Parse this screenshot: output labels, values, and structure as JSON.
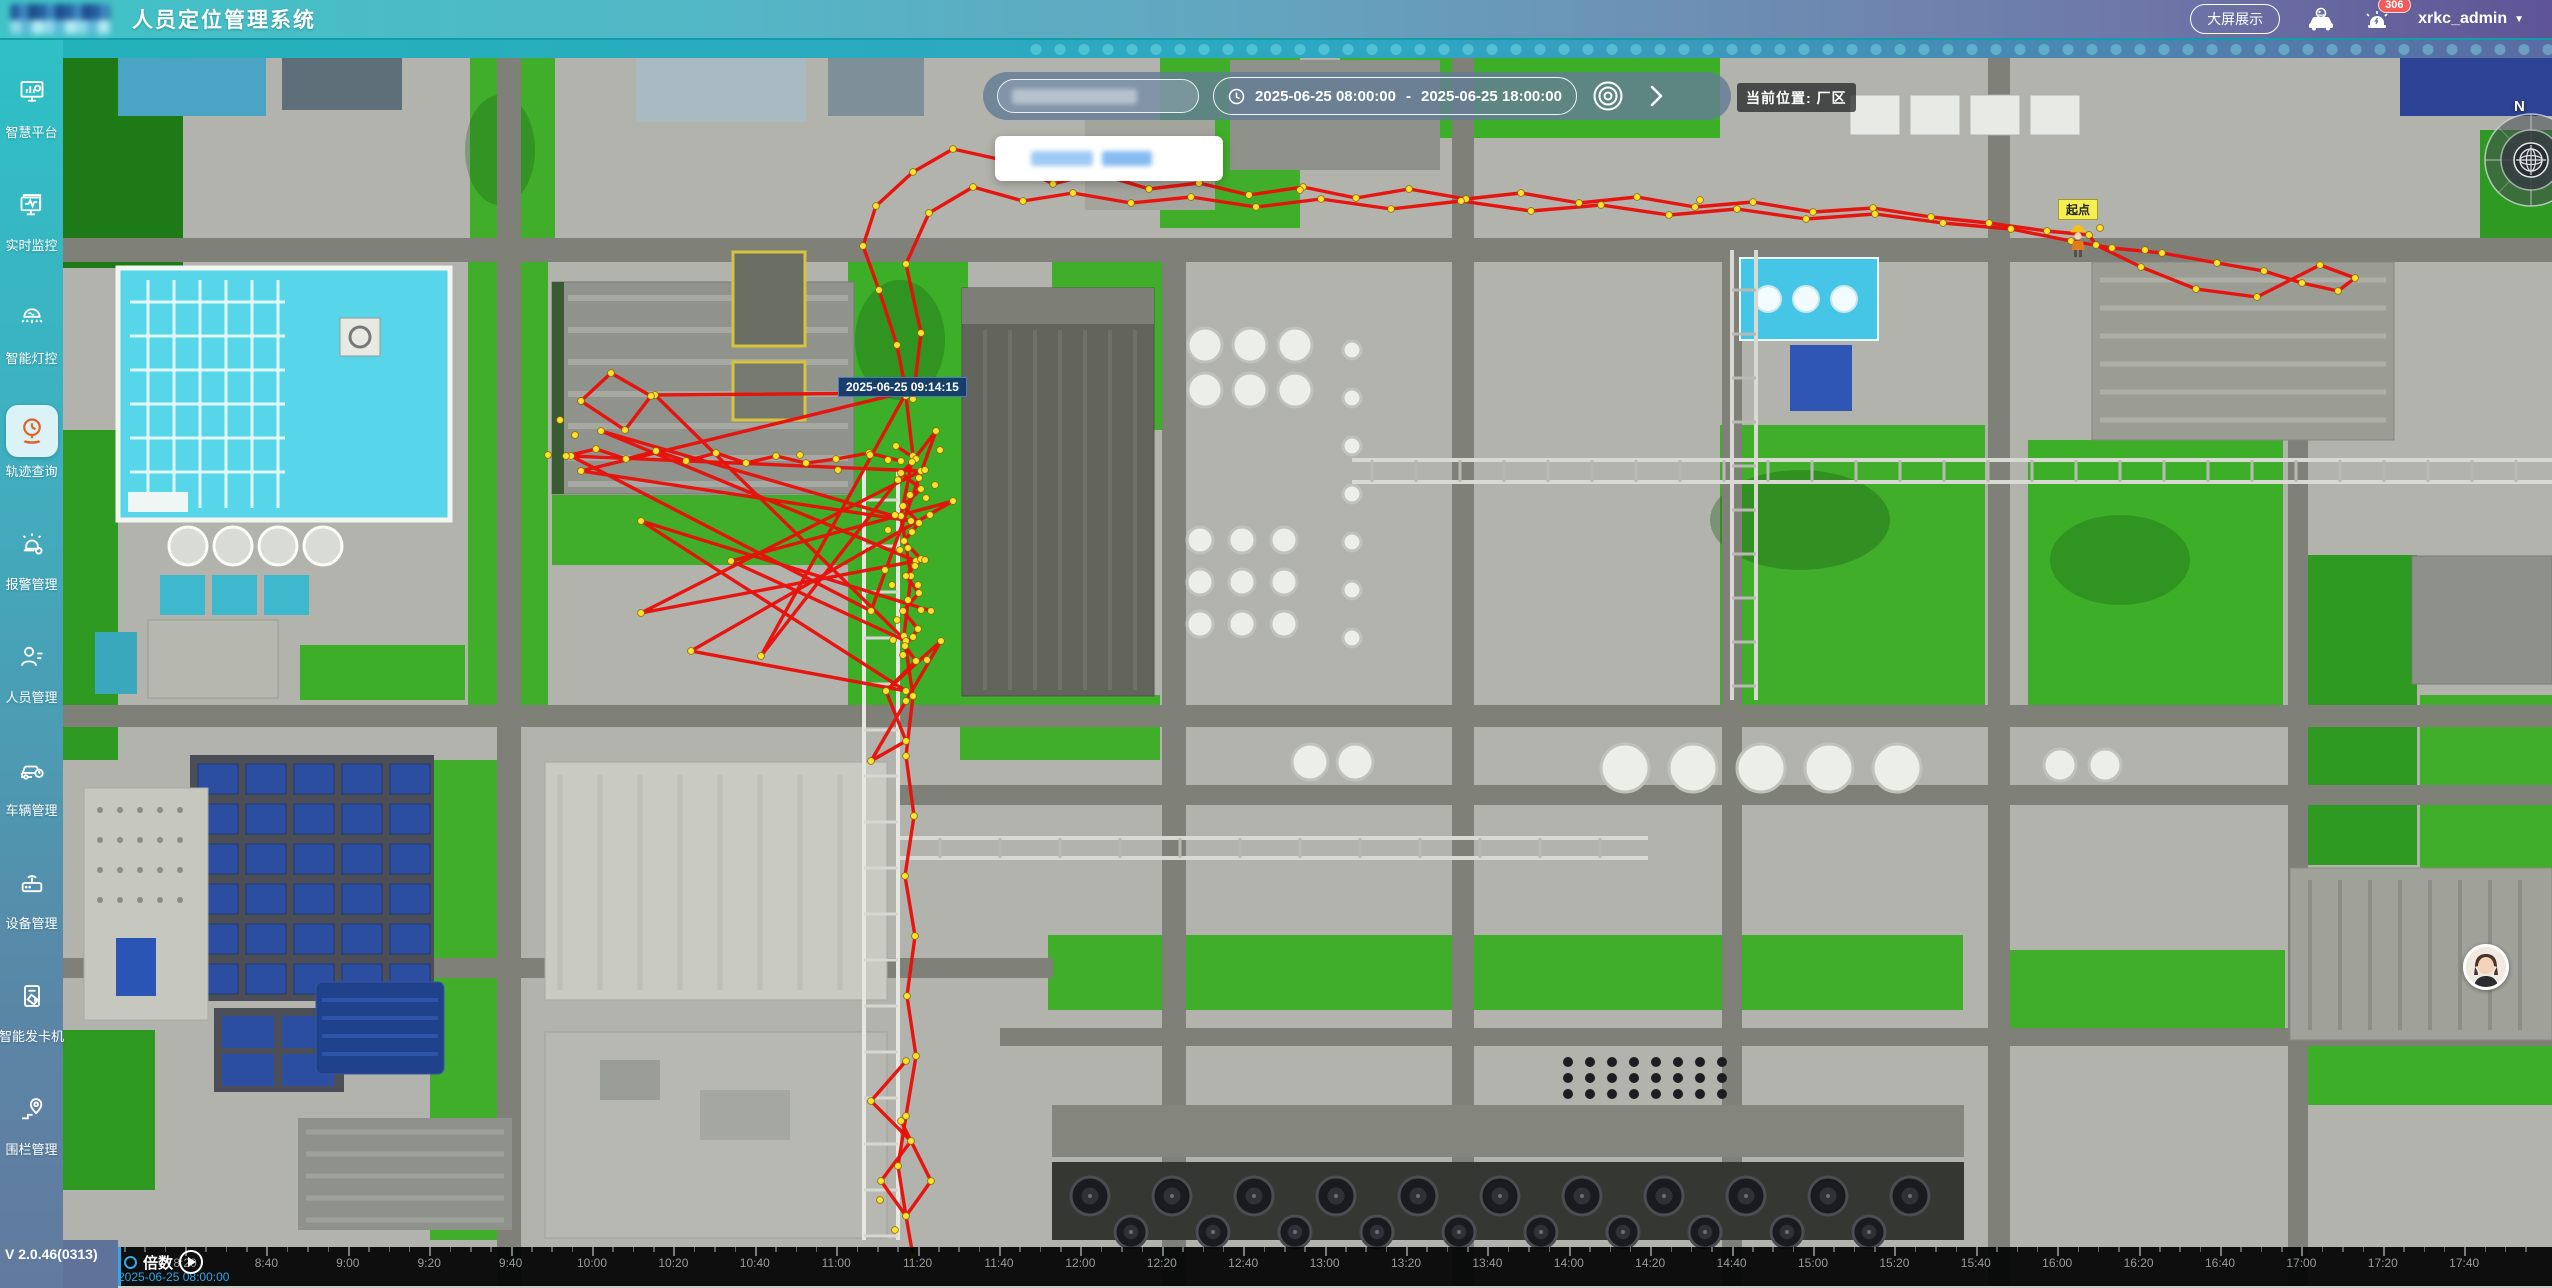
{
  "header": {
    "title": "人员定位管理系统",
    "big_screen_button": "大屏展示",
    "notification_badge": "306",
    "username": "xrkc_admin"
  },
  "sidebar": {
    "items": [
      {
        "label": "智慧平台",
        "icon": "dashboard-monitor-icon",
        "active": false
      },
      {
        "label": "实时监控",
        "icon": "realtime-monitor-icon",
        "active": false
      },
      {
        "label": "智能灯控",
        "icon": "smart-light-icon",
        "active": false
      },
      {
        "label": "轨迹查询",
        "icon": "track-query-icon",
        "active": true
      },
      {
        "label": "报警管理",
        "icon": "alarm-icon",
        "active": false
      },
      {
        "label": "人员管理",
        "icon": "person-icon",
        "active": false
      },
      {
        "label": "车辆管理",
        "icon": "vehicle-icon",
        "active": false
      },
      {
        "label": "设备管理",
        "icon": "device-icon",
        "active": false
      },
      {
        "label": "智能发卡机",
        "icon": "card-dispenser-icon",
        "active": false
      },
      {
        "label": "围栏管理",
        "icon": "fence-icon",
        "active": false
      }
    ],
    "version": "V 2.0.46(0313)"
  },
  "toolbar": {
    "date_start": "2025-06-25 08:00:00",
    "date_separator": "-",
    "date_end": "2025-06-25 18:00:00",
    "location_label": "当前位置: 厂区"
  },
  "map": {
    "tooltip_time": "2025-06-25 09:14:15",
    "start_point_label": "起点",
    "compass_north": "N",
    "track_color": "#e90f08",
    "dot_color": "#ffe22e"
  },
  "timeline": {
    "speed_label": "倍数",
    "current_time": "2025-06-25 08:00:00",
    "tick_labels": [
      "8:20",
      "8:40",
      "9:00",
      "9:20",
      "9:40",
      "10:00",
      "10:20",
      "10:40",
      "11:00",
      "11:20",
      "11:40",
      "12:00",
      "12:20",
      "12:40",
      "13:00",
      "13:20",
      "13:40",
      "14:00",
      "14:20",
      "14:40",
      "15:00",
      "15:20",
      "15:40",
      "16:00",
      "16:20",
      "16:40",
      "17:00",
      "17:20",
      "17:40"
    ]
  },
  "trajectory": {
    "paths": [
      [
        906,
        392,
        897,
        345,
        879,
        290,
        863,
        246,
        876,
        206,
        913,
        172,
        953,
        149,
        1007,
        161,
        1053,
        184,
        1096,
        173,
        1149,
        189,
        1199,
        183,
        1249,
        195,
        1303,
        187,
        1356,
        198,
        1409,
        189,
        1466,
        199,
        1521,
        193,
        1579,
        203,
        1637,
        197,
        1695,
        207,
        1753,
        202,
        1813,
        212,
        1873,
        208,
        1931,
        217,
        1989,
        223,
        2047,
        231,
        2089,
        235
      ],
      [
        913,
        399,
        921,
        333,
        906,
        264,
        929,
        213,
        973,
        187,
        1023,
        201,
        1073,
        193,
        1131,
        203,
        1191,
        197,
        1256,
        207,
        1321,
        199,
        1391,
        209,
        1461,
        201,
        1531,
        211,
        1601,
        205,
        1669,
        215,
        1737,
        209,
        1806,
        219,
        1875,
        214,
        1943,
        223,
        2011,
        229,
        2071,
        241,
        2112,
        248,
        2162,
        253,
        2217,
        263,
        2264,
        271,
        2302,
        283,
        2338,
        291,
        2355,
        278,
        2320,
        265,
        2257,
        297,
        2196,
        289,
        2141,
        267,
        2096,
        245,
        2089,
        235
      ],
      [
        906,
        396,
        913,
        456,
        901,
        516,
        911,
        576,
        904,
        636,
        913,
        696,
        906,
        756,
        914,
        816,
        905,
        876,
        915,
        936,
        907,
        996,
        916,
        1056,
        906,
        1116,
        898,
        1166,
        906,
        1216,
        913,
        1256
      ],
      [
        906,
        392,
        581,
        471,
        911,
        521,
        601,
        431,
        916,
        561,
        641,
        613,
        921,
        471,
        571,
        456,
        871,
        611,
        936,
        431,
        761,
        656,
        906,
        393,
        655,
        395,
        906,
        641,
        731,
        561,
        953,
        501,
        691,
        651,
        906,
        691,
        641,
        521,
        931,
        611
      ],
      [
        566,
        456,
        596,
        449,
        626,
        459,
        656,
        451,
        686,
        461,
        716,
        453,
        746,
        463,
        776,
        456,
        806,
        463,
        836,
        459,
        869,
        453,
        901,
        461
      ],
      [
        896,
        446,
        916,
        459,
        901,
        473,
        921,
        489,
        903,
        506,
        919,
        523,
        904,
        541,
        921,
        559,
        906,
        576,
        919,
        593,
        903,
        611,
        918,
        629,
        905,
        646,
        916,
        661,
        886,
        691,
        906,
        741,
        871,
        761,
        906,
        701,
        941,
        641,
        886,
        691
      ],
      [
        906,
        1061,
        871,
        1101,
        911,
        1141,
        881,
        1181,
        906,
        1216,
        931,
        1181,
        901,
        1121
      ],
      [
        581,
        401,
        611,
        373,
        651,
        396,
        625,
        430,
        581,
        401
      ]
    ],
    "extra_dots": [
      [
        888,
        460
      ],
      [
        898,
        480
      ],
      [
        910,
        495
      ],
      [
        895,
        515
      ],
      [
        912,
        532
      ],
      [
        900,
        550
      ],
      [
        915,
        566
      ],
      [
        892,
        585
      ],
      [
        908,
        600
      ],
      [
        897,
        620
      ],
      [
        913,
        637
      ],
      [
        903,
        655
      ],
      [
        921,
        610
      ],
      [
        925,
        560
      ],
      [
        930,
        515
      ],
      [
        888,
        530
      ],
      [
        885,
        570
      ],
      [
        925,
        470
      ],
      [
        935,
        485
      ],
      [
        940,
        450
      ],
      [
        560,
        420
      ],
      [
        575,
        435
      ],
      [
        548,
        455
      ],
      [
        880,
        1200
      ],
      [
        895,
        1230
      ],
      [
        1095,
        165
      ],
      [
        1300,
        190
      ],
      [
        1700,
        200
      ],
      [
        2100,
        228
      ],
      [
        2145,
        250
      ],
      [
        912,
        462
      ],
      [
        919,
        478
      ],
      [
        926,
        498
      ],
      [
        908,
        548
      ],
      [
        918,
        585
      ],
      [
        893,
        640
      ],
      [
        927,
        660
      ],
      [
        870,
        455
      ],
      [
        838,
        470
      ],
      [
        800,
        455
      ]
    ]
  }
}
